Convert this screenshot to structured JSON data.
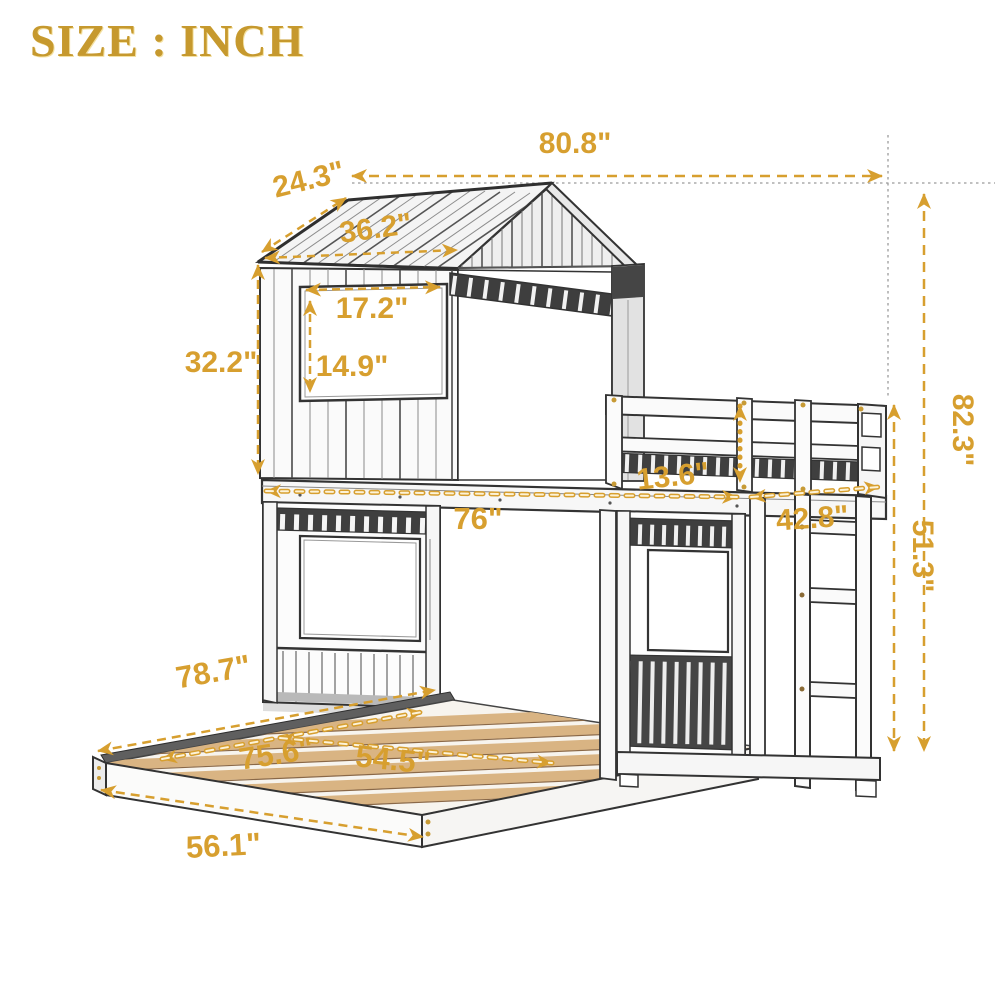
{
  "title": "SIZE : INCH",
  "colors": {
    "dimension_accent": "#D79F2F",
    "title_gold": "#C6992E",
    "slat_wood": "#D9B483",
    "sketch_line": "#3A3A3A"
  },
  "dimensions": {
    "overall_width": "80.8\"",
    "roof_slope_depth": "24.3\"",
    "roof_front_width": "36.2\"",
    "window_width": "17.2\"",
    "window_height": "14.9\"",
    "upper_house_height": "32.2\"",
    "overall_height": "82.3\"",
    "guardrail_height": "13.6\"",
    "upper_bunk_length": "76\"",
    "upper_bed_width": "42.8\"",
    "under_loft_height": "51.3\"",
    "lower_bed_length": "78.7\"",
    "lower_bed_slat_length": "75.6\"",
    "lower_bed_inner_width": "54.5\"",
    "lower_bed_width": "56.1\""
  }
}
